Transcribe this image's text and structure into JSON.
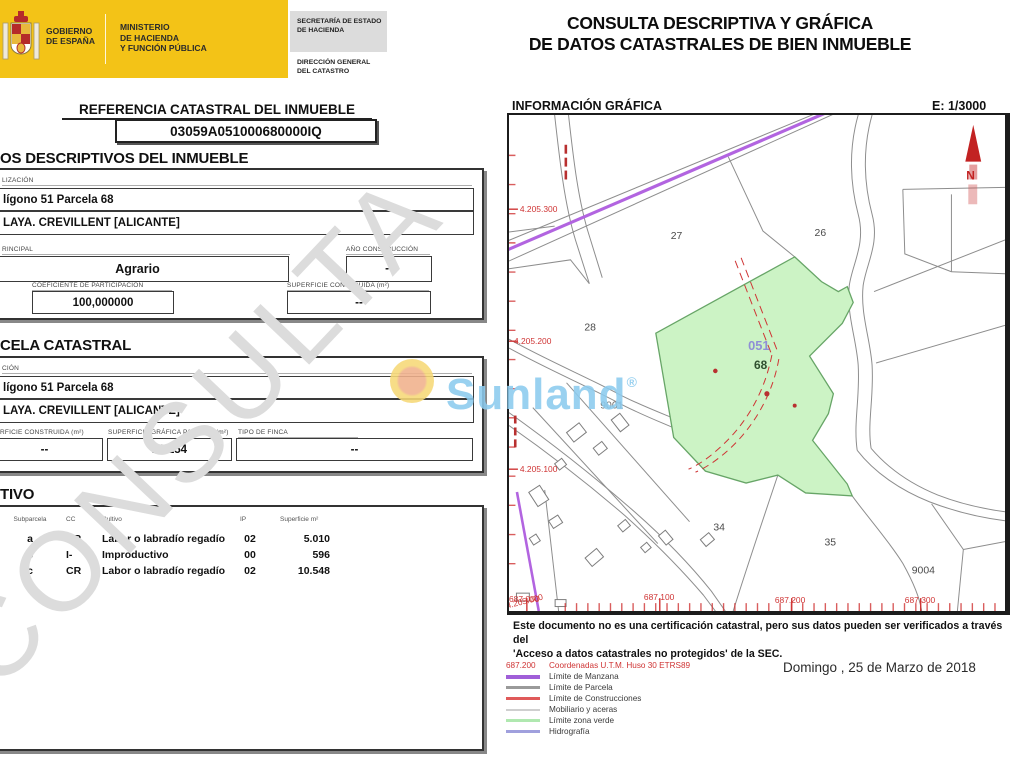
{
  "header": {
    "gobierno1": "GOBIERNO",
    "gobierno2": "DE ESPAÑA",
    "ministerio1": "MINISTERIO",
    "ministerio2": "DE HACIENDA",
    "ministerio3": "Y FUNCIÓN PÚBLICA",
    "secretaria1": "SECRETARÍA DE ESTADO",
    "secretaria2": "DE HACIENDA",
    "direccion1": "DIRECCIÓN GENERAL",
    "direccion2": "DEL CATASTRO",
    "title_line1": "CONSULTA DESCRIPTIVA Y GRÁFICA",
    "title_line2": "DE DATOS CATASTRALES DE BIEN INMUEBLE"
  },
  "referencia": {
    "label": "REFERENCIA CATASTRAL DEL INMUEBLE",
    "value": "03059A051000680000IQ"
  },
  "datos": {
    "heading": "OS DESCRIPTIVOS DEL INMUEBLE",
    "loc_label": "LIZACIÓN",
    "loc_line1": "lígono 51 Parcela 68",
    "loc_line2": "LAYA. CREVILLENT [ALICANTE]",
    "uso_label": "RINCIPAL",
    "uso_value": "Agrario",
    "ano_label": "AÑO CONSTRUCCIÓN",
    "ano_value": "--",
    "coef_label": "COEFICIENTE DE PARTICIPACIÓN",
    "coef_value": "100,000000",
    "supc_label": "SUPERFICIE CONSTRUIDA (m²)",
    "supc_value": "--"
  },
  "parcela": {
    "heading": "CELA CATASTRAL",
    "loc_label": "CIÓN",
    "loc_line1": "lígono 51 Parcela 68",
    "loc_line2": "LAYA. CREVILLENT [ALICANTE]",
    "supc_label": "RFICIE CONSTRUIDA (m²)",
    "supc_value": "--",
    "supg_label": "SUPERFICIE GRÁFICA PARCELA (m²)",
    "supg_value": "16.154",
    "tipo_label": "TIPO DE FINCA",
    "tipo_value": "--"
  },
  "cultivo": {
    "heading": "TIVO",
    "columns": [
      "Subparcela",
      "CC",
      "Cultivo",
      "IP",
      "Superficie m²"
    ],
    "rows": [
      [
        "a",
        "CR",
        "Labor o labradío regadío",
        "02",
        "5.010"
      ],
      [
        "b",
        "I-",
        "Improductivo",
        "00",
        "596"
      ],
      [
        "c",
        "CR",
        "Labor o labradío regadío",
        "02",
        "10.548"
      ]
    ]
  },
  "map": {
    "heading": "INFORMACIÓN GRÁFICA",
    "scale": "E: 1/3000",
    "labels": {
      "p27": "27",
      "p26": "26",
      "p28": "28",
      "p34": "34",
      "p35": "35",
      "p9001": "9001",
      "p9004": "9004",
      "codigo": "051",
      "parcela": "68",
      "north": "N"
    },
    "coords_left": [
      "4.205.300",
      "4.205.200",
      "4.205.100"
    ],
    "coords_bottom": [
      "687.000",
      "687.100",
      "687.200",
      "687.300"
    ],
    "coord_overlap": "4.205.000"
  },
  "footer": {
    "disclaimer_line1": "Este documento no es una certificación catastral, pero sus datos pueden ser verificados a través del",
    "disclaimer_line2": "'Acceso a datos catastrales no protegidos' de la SEC.",
    "legend_coord_sample": "687.200",
    "legend_coord_label": "Coordenadas U.T.M. Huso 30 ETRS89",
    "legend_items": [
      {
        "label": "Límite de Manzana",
        "color": "#a05fd8"
      },
      {
        "label": "Límite de Parcela",
        "color": "#9a9a9a"
      },
      {
        "label": "Límite de Construcciones",
        "color": "#e05a5a"
      },
      {
        "label": "Mobiliario y aceras",
        "color": "#cfcfcf"
      },
      {
        "label": "Límite zona verde",
        "color": "#b0e8b0"
      },
      {
        "label": "Hidrografía",
        "color": "#a0a0dd"
      }
    ],
    "date": "Domingo , 25 de Marzo de 2018"
  },
  "watermark": {
    "consulta": "CONSULTA",
    "sunland": "Sunland",
    "registered": "®"
  },
  "colors": {
    "banner_yellow": "#f3c317",
    "map_green_fill": "#ccf3c5",
    "map_purple": "#b264e0",
    "map_red": "#cf3434",
    "sunland_blue": "#8ccbee"
  }
}
